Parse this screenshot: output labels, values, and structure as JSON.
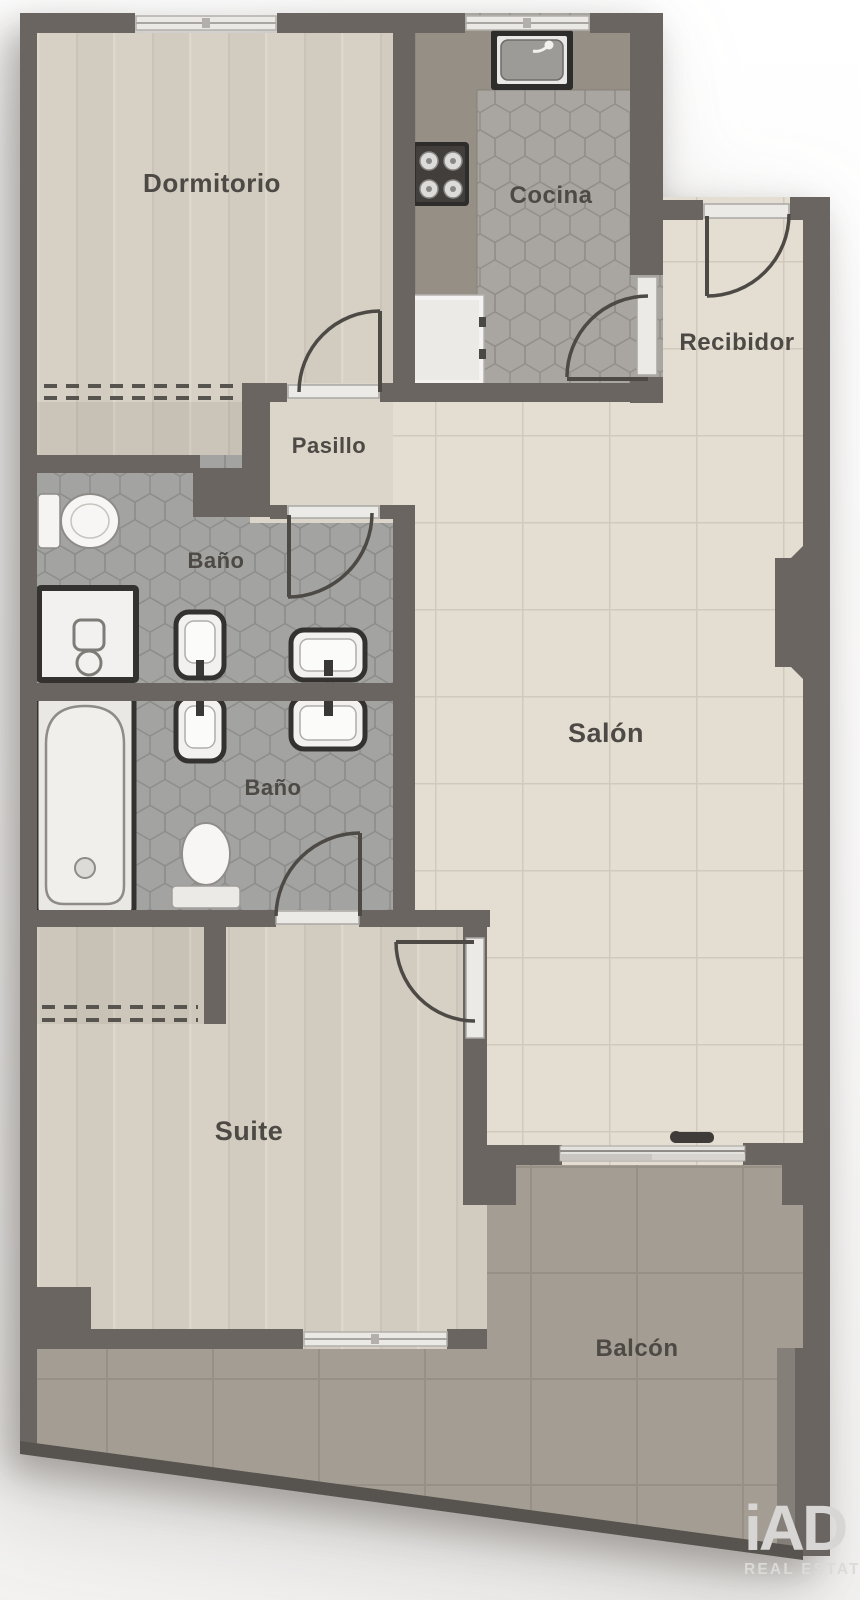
{
  "plan": {
    "type": "floorplan",
    "rooms": [
      {
        "id": "dormitorio",
        "label": "Dormitorio"
      },
      {
        "id": "cocina",
        "label": "Cocina"
      },
      {
        "id": "recibidor",
        "label": "Recibidor"
      },
      {
        "id": "pasillo",
        "label": "Pasillo"
      },
      {
        "id": "bano-1",
        "label": "Baño"
      },
      {
        "id": "bano-2",
        "label": "Baño"
      },
      {
        "id": "salon",
        "label": "Salón"
      },
      {
        "id": "suite",
        "label": "Suite"
      },
      {
        "id": "balcon",
        "label": "Balcón"
      }
    ]
  },
  "branding": {
    "logo_text": "iAD",
    "logo_sub": "REAL ESTATE"
  },
  "colors": {
    "wall": "#6a6561",
    "floor_wood": "#d6d0c5",
    "floor_tile_light": "#e3ddd2",
    "floor_hex_kitchen": "#a9a6a1",
    "floor_hex_bath": "#a3a3a1",
    "floor_balcony": "#a49d93",
    "counter": "#968f85",
    "label_text": "#4d4945",
    "logo": "#d7d6d4"
  }
}
